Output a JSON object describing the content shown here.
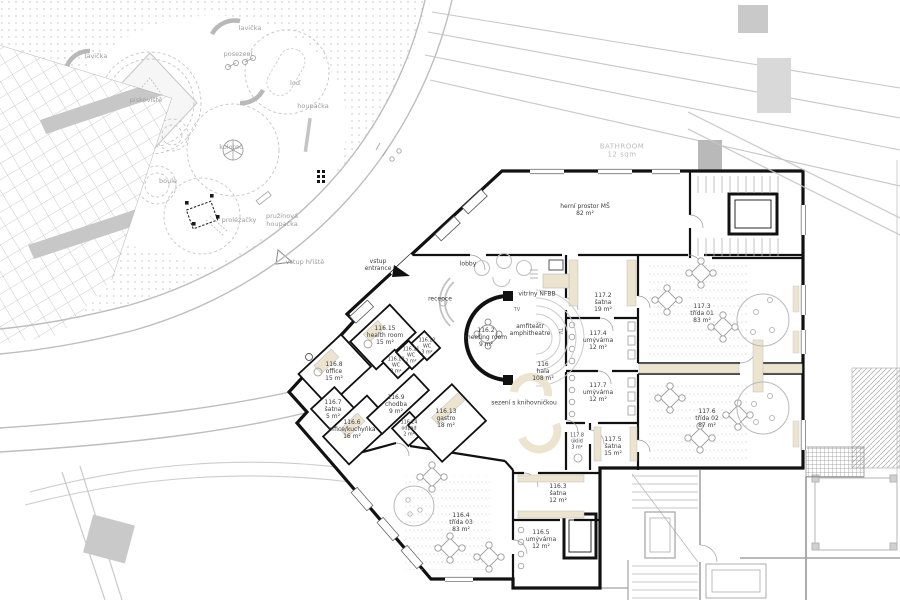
{
  "colors": {
    "wall": "#111111",
    "site_gray": "#9d9d9d",
    "light_gray": "#c8c8c8",
    "furniture_beige": "#ece4cf",
    "paper": "#ffffff"
  },
  "site_labels": {
    "lavicka1": "lavička",
    "lavicka2": "lavička",
    "posezeni": "posezení",
    "lod": "loď",
    "piskoviste": "pískoviště",
    "houpacka": "houpačka",
    "kolotoc": "kolotoč",
    "boule": "boule",
    "prolezacky": "prolézačky",
    "pruzinova_l1": "pružinová",
    "pruzinova_l2": "houpačka",
    "vstup_hriste": "vstup hřiště"
  },
  "overlay": {
    "bathroom_l1": "BATHROOM",
    "bathroom_l2": "12 sqm"
  },
  "markers": {
    "entrance_l1": "vstup",
    "entrance_l2": "entrance"
  },
  "hall_labels": {
    "lobby": "lobby",
    "reception": "recepce",
    "display_case": "vitríny NFBB",
    "amphitheatre_cz": "amfiteátr",
    "amphitheatre_en": "amphitheatre",
    "seating": "sezení s knihovničkou",
    "tv1": "TV",
    "tv2": "TV"
  },
  "rooms": [
    {
      "id": "116",
      "name": "hala",
      "area": "108 m²"
    },
    {
      "id": "116.2",
      "name": "meeting room",
      "area": "9 m²"
    },
    {
      "id": "116.3",
      "name": "šatna",
      "area": "12 m²"
    },
    {
      "id": "116.4",
      "name": "třída 03",
      "area": "83 m²"
    },
    {
      "id": "116.5",
      "name": "umývárna",
      "area": "12 m²"
    },
    {
      "id": "116.6",
      "name": "office/kuchyňka",
      "area": "16 m²"
    },
    {
      "id": "116.7",
      "name": "šatna",
      "area": "5 m²"
    },
    {
      "id": "116.8",
      "name": "office",
      "area": "15 m²"
    },
    {
      "id": "116.9",
      "name": "chodba",
      "area": "9 m²"
    },
    {
      "id": "116.10",
      "name": "WC",
      "area": "2 m²"
    },
    {
      "id": "116.11",
      "name": "WC",
      "area": "2 m²"
    },
    {
      "id": "116.12",
      "name": "WC",
      "area": "3 m²"
    },
    {
      "id": "116.13",
      "name": "gastro",
      "area": "18 m²"
    },
    {
      "id": "116.14",
      "name": "odpad",
      "area": "2 m²"
    },
    {
      "id": "116.15",
      "name": "health room",
      "area": "15 m²"
    },
    {
      "id": "117.2",
      "name": "šatna",
      "area": "19 m²"
    },
    {
      "id": "117.3",
      "name": "třída 01",
      "area": "83 m²"
    },
    {
      "id": "117.4",
      "name": "umývárna",
      "area": "12 m²"
    },
    {
      "id": "117.5",
      "name": "šatna",
      "area": "15 m²"
    },
    {
      "id": "117.6",
      "name": "třída 02",
      "area": "87 m²"
    },
    {
      "id": "117.7",
      "name": "umývárna",
      "area": "12 m²"
    },
    {
      "id": "117.8",
      "name": "úklid",
      "area": "3 m²"
    },
    {
      "id": "",
      "name": "herní prostor MŠ",
      "area": "82 m²"
    }
  ]
}
